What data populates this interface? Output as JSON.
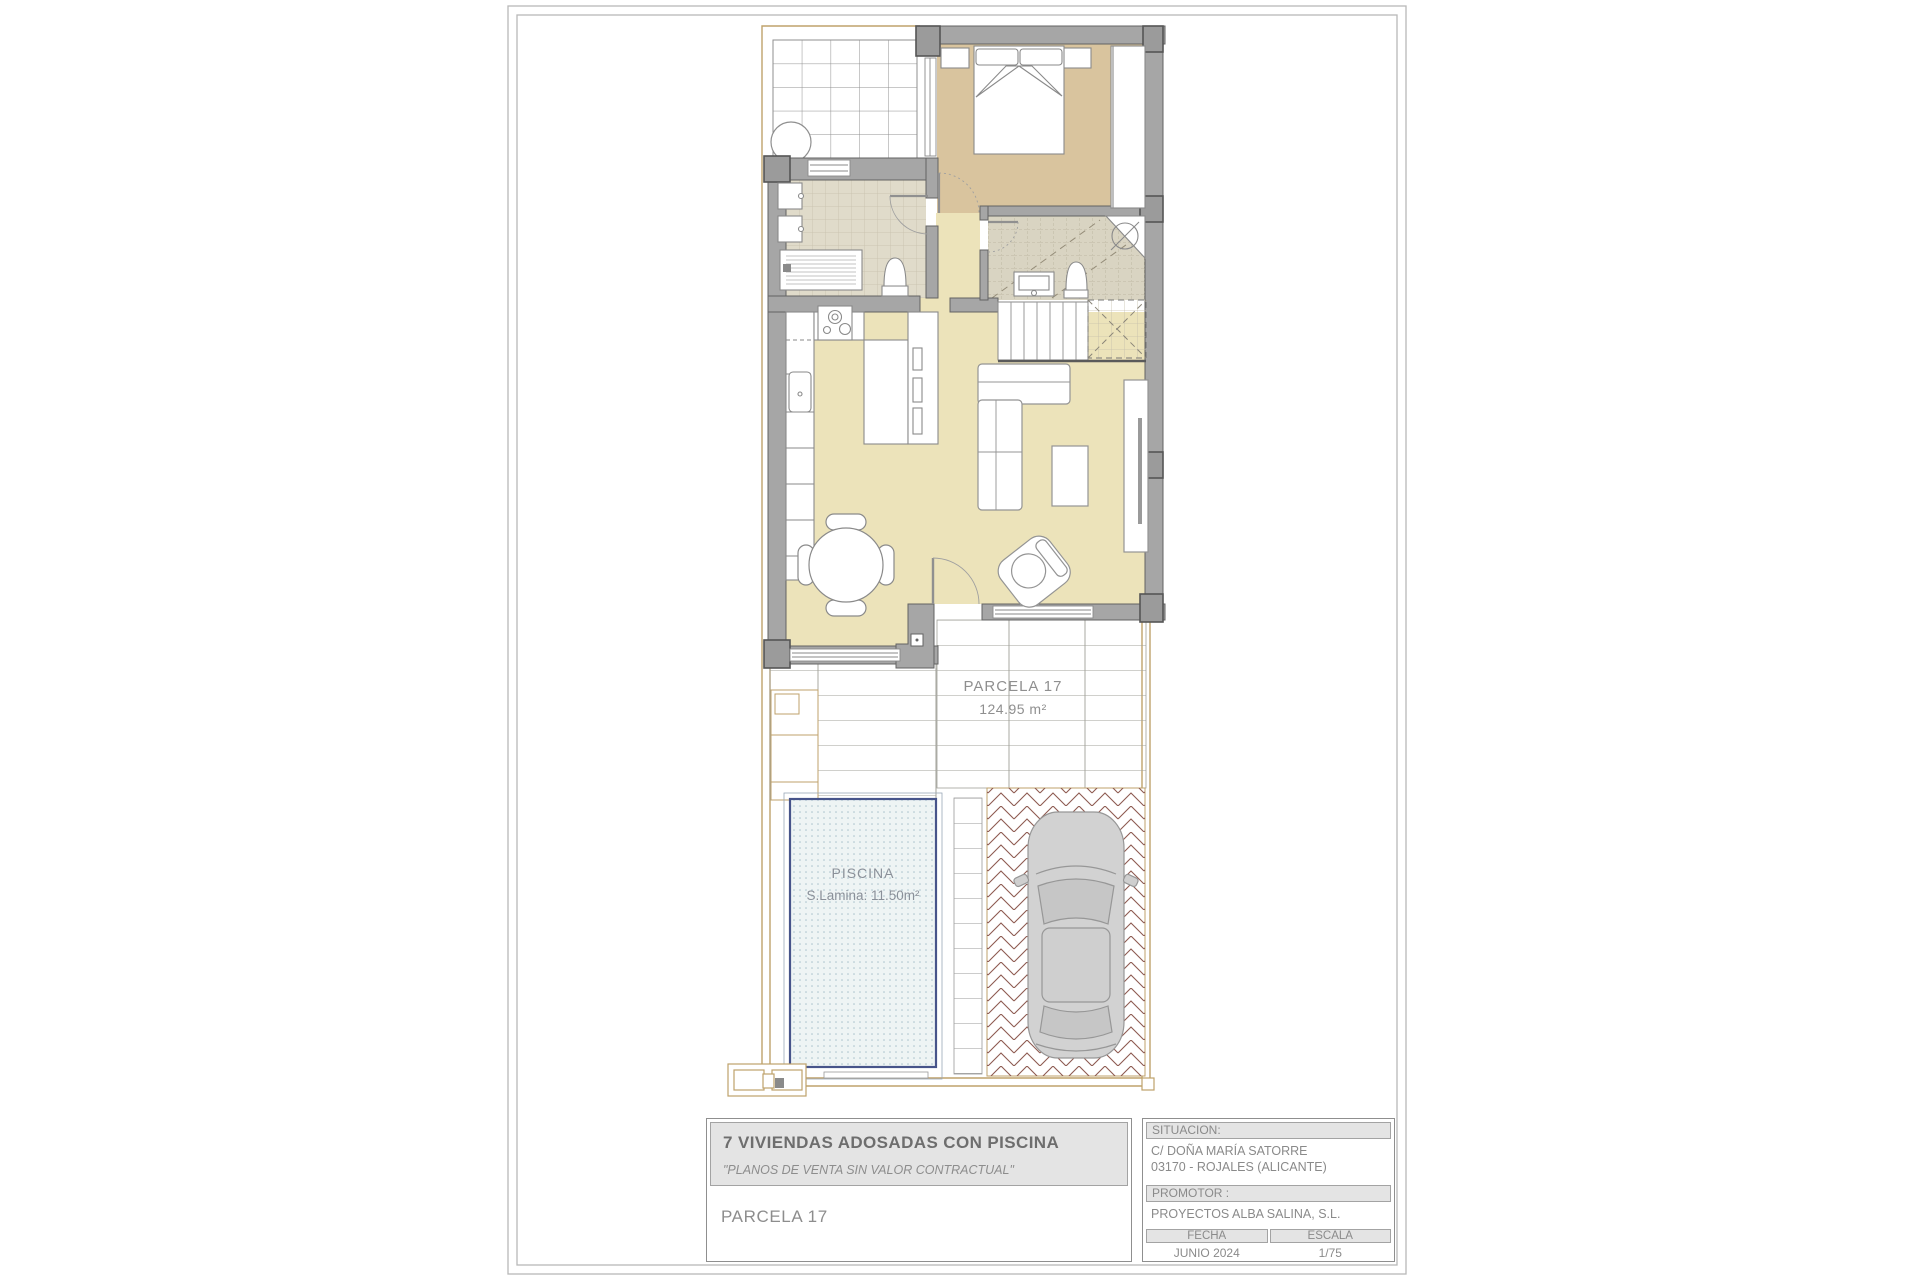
{
  "plan_labels": {
    "parcel_name": "PARCELA 17",
    "parcel_area": "124.95 m²",
    "pool_name": "PISCINA",
    "pool_area": "S.Lamina: 11.50m²"
  },
  "title_block": {
    "project_title": "7 VIVIENDAS ADOSADAS CON PISCINA",
    "disclaimer": "\"PLANOS DE VENTA SIN VALOR CONTRACTUAL\"",
    "parcel": "PARCELA 17",
    "situacion": {
      "label": "SITUACION:",
      "address_line1": "C/ DOÑA MARÍA SATORRE",
      "address_line2": "03170 - ROJALES (ALICANTE)"
    },
    "promotor": {
      "label": "PROMOTOR :",
      "value": "PROYECTOS ALBA SALINA, S.L."
    },
    "fecha": {
      "label": "FECHA",
      "value": "JUNIO 2024"
    },
    "escala": {
      "label": "ESCALA",
      "value": "1/75"
    }
  },
  "colors": {
    "wall": "#a6a6a6",
    "wall_dark": "#9b9b9b",
    "bedroom_floor": "#d9c49e",
    "living_floor": "#ece3ba",
    "bath_floor": "#e0dbca",
    "ensuite_floor": "#d9d4c2",
    "boundary_tan": "#bfa26b",
    "pool_water": "#eef4f4",
    "pool_border": "#47548a",
    "herringbone": "#8d5a50",
    "car_body": "#d2d2d2"
  }
}
